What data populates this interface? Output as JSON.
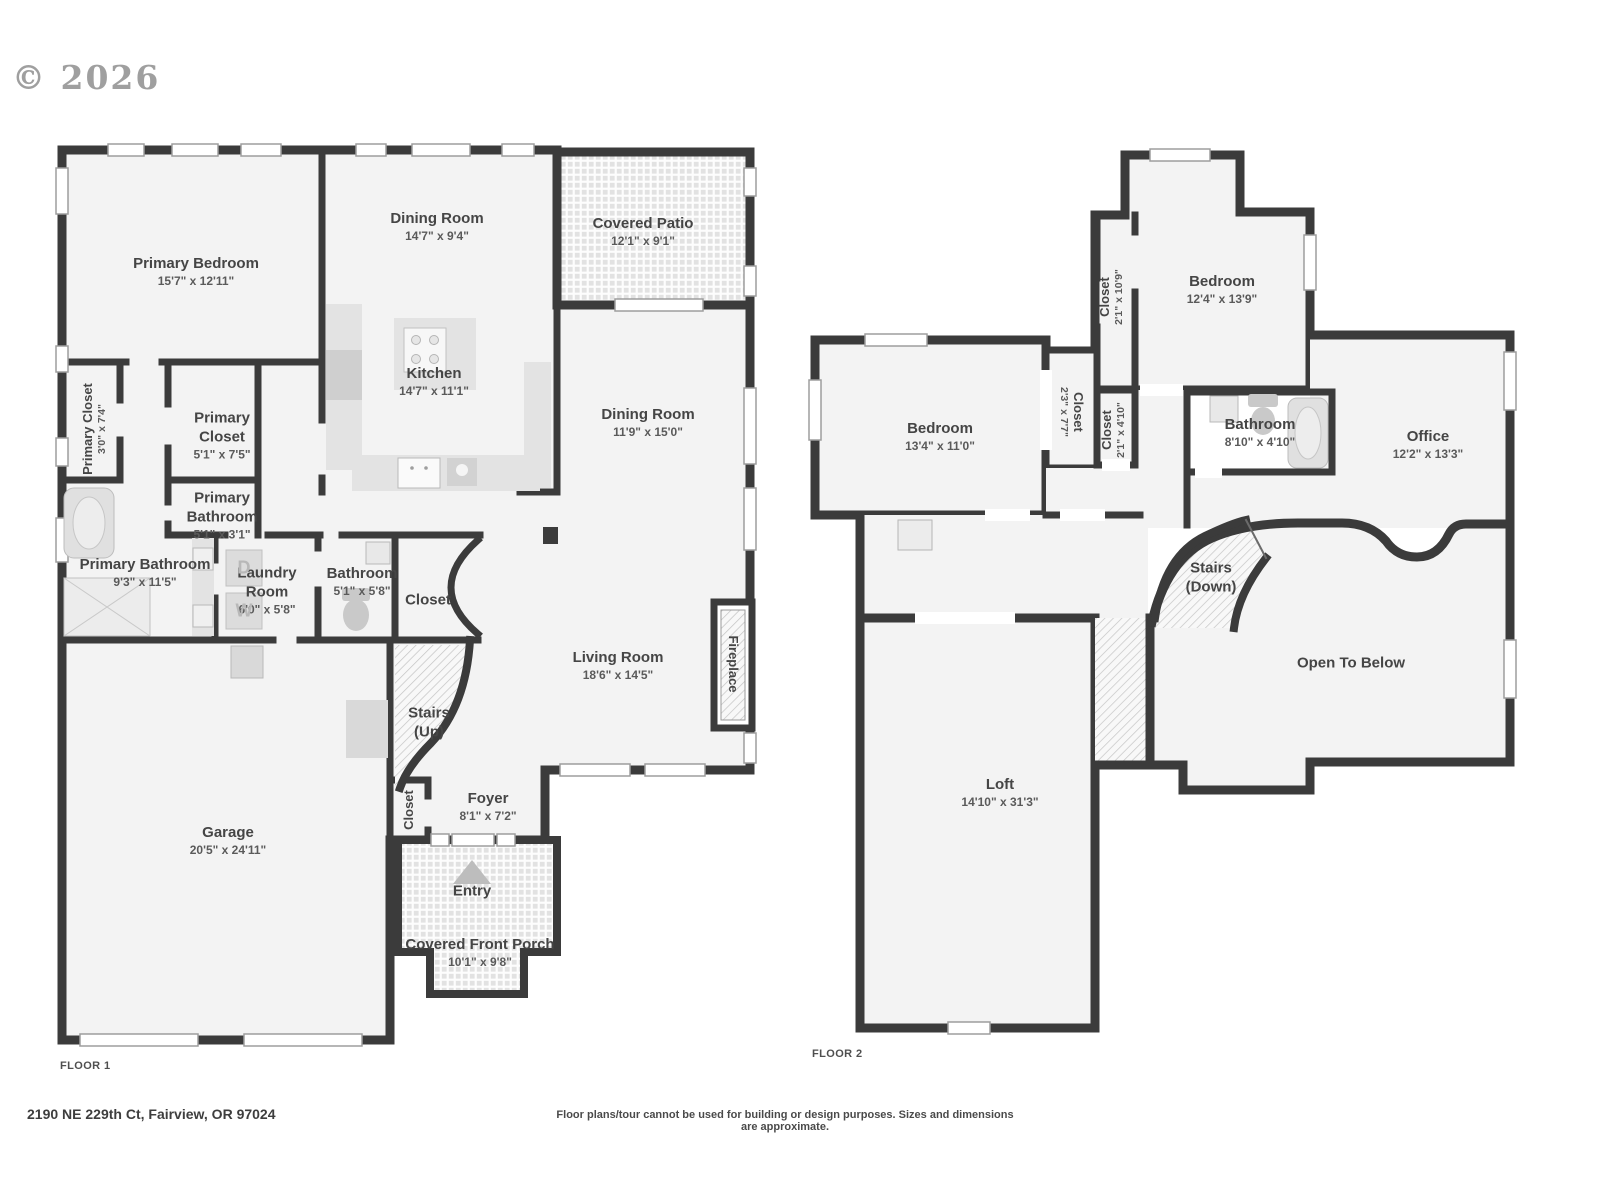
{
  "watermark": "© 2026",
  "colors": {
    "wall": "#3b3b3b",
    "room_fill": "#f3f3f3",
    "fixture": "#e0e0e0",
    "label_text": "#454545",
    "watermark_text": "#8f8f8f"
  },
  "floor1": {
    "label": "FLOOR 1",
    "laundry": {
      "dryer_letter": "D",
      "washer_letter": "W"
    },
    "rooms": [
      {
        "name": "Primary Bedroom",
        "dims": "15'7\" x 12'11\""
      },
      {
        "name": "Dining Room",
        "dims": "14'7\" x 9'4\""
      },
      {
        "name": "Covered Patio",
        "dims": "12'1\" x 9'1\""
      },
      {
        "name": "Primary Closet",
        "dims": "3'0\" x 7'4\""
      },
      {
        "name": "Primary Closet",
        "dims": "5'1\" x 7'5\""
      },
      {
        "name": "Kitchen",
        "dims": "14'7\" x 11'1\""
      },
      {
        "name": "Dining Room",
        "dims": "11'9\" x 15'0\""
      },
      {
        "name": "Primary Bathroom",
        "dims": "5'1\" x 3'1\""
      },
      {
        "name": "Primary Bathroom",
        "dims": "9'3\" x 11'5\""
      },
      {
        "name": "Laundry Room",
        "dims": "6'0\" x 5'8\""
      },
      {
        "name": "Bathroom",
        "dims": "5'1\" x 5'8\""
      },
      {
        "name": "Closet",
        "dims": ""
      },
      {
        "name": "Living Room",
        "dims": "18'6\" x 14'5\""
      },
      {
        "name": "Fireplace",
        "dims": ""
      },
      {
        "name": "Stairs (Up)",
        "dims": ""
      },
      {
        "name": "Closet",
        "dims": ""
      },
      {
        "name": "Foyer",
        "dims": "8'1\" x 7'2\""
      },
      {
        "name": "Entry",
        "dims": ""
      },
      {
        "name": "Covered Front Porch",
        "dims": "10'1\" x 9'8\""
      },
      {
        "name": "Garage",
        "dims": "20'5\" x 24'11\""
      }
    ]
  },
  "floor2": {
    "label": "FLOOR 2",
    "rooms": [
      {
        "name": "Closet",
        "dims": "2'1\" x 10'9\""
      },
      {
        "name": "Bedroom",
        "dims": "12'4\" x 13'9\""
      },
      {
        "name": "Bedroom",
        "dims": "13'4\" x 11'0\""
      },
      {
        "name": "Closet",
        "dims": "2'3\" x 7'7\""
      },
      {
        "name": "Closet",
        "dims": "2'1\" x 4'10\""
      },
      {
        "name": "Bathroom",
        "dims": "8'10\" x 4'10\""
      },
      {
        "name": "Office",
        "dims": "12'2\" x 13'3\""
      },
      {
        "name": "Stairs (Down)",
        "dims": ""
      },
      {
        "name": "Open To Below",
        "dims": ""
      },
      {
        "name": "Loft",
        "dims": "14'10\" x 31'3\""
      }
    ]
  },
  "footer": {
    "address": "2190 NE 229th Ct, Fairview, OR 97024",
    "disclaimer": "Floor plans/tour cannot be used for building or design purposes. Sizes and dimensions are approximate."
  }
}
